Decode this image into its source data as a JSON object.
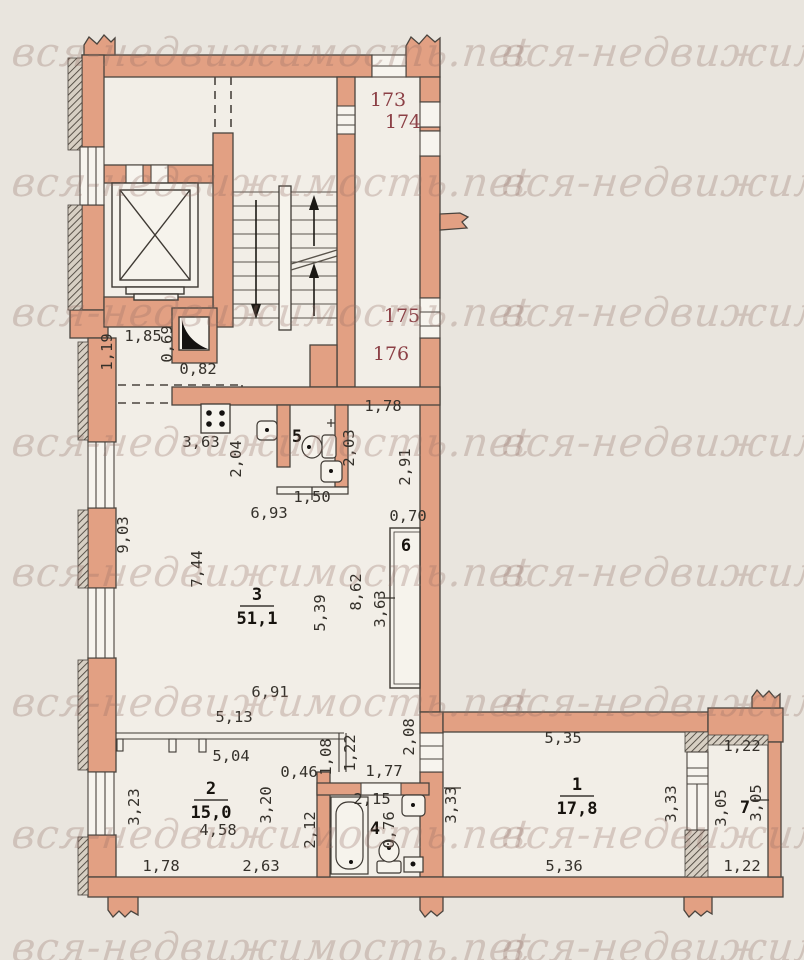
{
  "watermark": {
    "text": "вся-недвижимость.net",
    "color": "rgba(150,112,102,0.30)",
    "font_size": 40,
    "rows": [
      30,
      160,
      290,
      420,
      550,
      680,
      812,
      925
    ],
    "cols": [
      12,
      502
    ]
  },
  "colors": {
    "background": "#e9e5de",
    "room_fill": "#f2eee7",
    "wall_fill": "#e2a083",
    "wall_stroke": "#4a443e",
    "dim_text": "#35312b",
    "unit_text": "#8c4046",
    "room_text": "#17130e"
  },
  "plan": {
    "unit_labels": [
      {
        "t": "173",
        "x": 388,
        "y": 106
      },
      {
        "t": "174",
        "x": 403,
        "y": 128
      },
      {
        "t": "175",
        "x": 402,
        "y": 322
      },
      {
        "t": "176",
        "x": 391,
        "y": 360
      }
    ],
    "room_labels": [
      {
        "num": "3",
        "area": "51,1",
        "x": 257,
        "y": 600
      },
      {
        "num": "2",
        "area": "15,0",
        "x": 211,
        "y": 794
      },
      {
        "num": "1",
        "area": "17,8",
        "x": 577,
        "y": 790
      },
      {
        "num": "4",
        "x": 375,
        "y": 834
      },
      {
        "num": "5",
        "x": 297,
        "y": 442
      },
      {
        "num": "6",
        "x": 406,
        "y": 551
      },
      {
        "num": "7",
        "x": 745,
        "y": 813
      }
    ],
    "dimensions": [
      {
        "t": "1,19",
        "x": 112,
        "y": 352,
        "r": -90
      },
      {
        "t": "1,85",
        "x": 143,
        "y": 341,
        "r": 0
      },
      {
        "t": "0,69",
        "x": 172,
        "y": 344,
        "r": -90
      },
      {
        "t": "0,82",
        "x": 198,
        "y": 374,
        "r": 0
      },
      {
        "t": "3,63",
        "x": 201,
        "y": 447,
        "r": 0
      },
      {
        "t": "2,04",
        "x": 241,
        "y": 459,
        "r": -90
      },
      {
        "t": "2,03",
        "x": 354,
        "y": 448,
        "r": -90
      },
      {
        "t": "1,78",
        "x": 383,
        "y": 411,
        "r": 0
      },
      {
        "t": "2,91",
        "x": 410,
        "y": 467,
        "r": -90
      },
      {
        "t": "1,50",
        "x": 312,
        "y": 502,
        "r": 0
      },
      {
        "t": "6,93",
        "x": 269,
        "y": 518,
        "r": 0
      },
      {
        "t": "0,70",
        "x": 408,
        "y": 521,
        "r": 0
      },
      {
        "t": "9,03",
        "x": 128,
        "y": 535,
        "r": -90
      },
      {
        "t": "7,44",
        "x": 202,
        "y": 569,
        "r": -90
      },
      {
        "t": "5,39",
        "x": 325,
        "y": 613,
        "r": -90
      },
      {
        "t": "8,62",
        "x": 361,
        "y": 592,
        "r": -90
      },
      {
        "t": "3,63",
        "x": 385,
        "y": 609,
        "r": -90
      },
      {
        "t": "6,91",
        "x": 270,
        "y": 697,
        "r": 0
      },
      {
        "t": "5,13",
        "x": 234,
        "y": 722,
        "r": 0
      },
      {
        "t": "5,04",
        "x": 231,
        "y": 761,
        "r": 0
      },
      {
        "t": "0,46",
        "x": 299,
        "y": 777,
        "r": 0
      },
      {
        "t": "1,08",
        "x": 331,
        "y": 757,
        "r": -90
      },
      {
        "t": "1,22",
        "x": 355,
        "y": 753,
        "r": -90
      },
      {
        "t": "1,77",
        "x": 384,
        "y": 776,
        "r": 0
      },
      {
        "t": "2,15",
        "x": 372,
        "y": 804,
        "r": 0
      },
      {
        "t": "2,08",
        "x": 414,
        "y": 737,
        "r": -90
      },
      {
        "t": "3,23",
        "x": 139,
        "y": 807,
        "r": -90
      },
      {
        "t": "3,20",
        "x": 271,
        "y": 805,
        "r": -90
      },
      {
        "t": "2,12",
        "x": 315,
        "y": 830,
        "r": -90
      },
      {
        "t": "4,58",
        "x": 218,
        "y": 835,
        "r": 0
      },
      {
        "t": "0,76",
        "x": 394,
        "y": 830,
        "r": -90
      },
      {
        "t": "1,78",
        "x": 161,
        "y": 871,
        "r": 0
      },
      {
        "t": "2,63",
        "x": 261,
        "y": 871,
        "r": 0
      },
      {
        "t": "5,35",
        "x": 563,
        "y": 743,
        "r": 0
      },
      {
        "t": "3,33",
        "x": 456,
        "y": 805,
        "r": -90
      },
      {
        "t": "3,33",
        "x": 676,
        "y": 804,
        "r": -90
      },
      {
        "t": "5,36",
        "x": 564,
        "y": 871,
        "r": 0
      },
      {
        "t": "1,22",
        "x": 742,
        "y": 751,
        "r": 0
      },
      {
        "t": "3,05",
        "x": 726,
        "y": 808,
        "r": -90
      },
      {
        "t": "3,05",
        "x": 761,
        "y": 803,
        "r": -90
      },
      {
        "t": "1,22",
        "x": 742,
        "y": 871,
        "r": 0
      }
    ],
    "ticks": [
      [
        312,
        487,
        312,
        500
      ],
      [
        378,
        598,
        395,
        598
      ],
      [
        444,
        788,
        461,
        788
      ],
      [
        752,
        800,
        769,
        800
      ]
    ]
  }
}
